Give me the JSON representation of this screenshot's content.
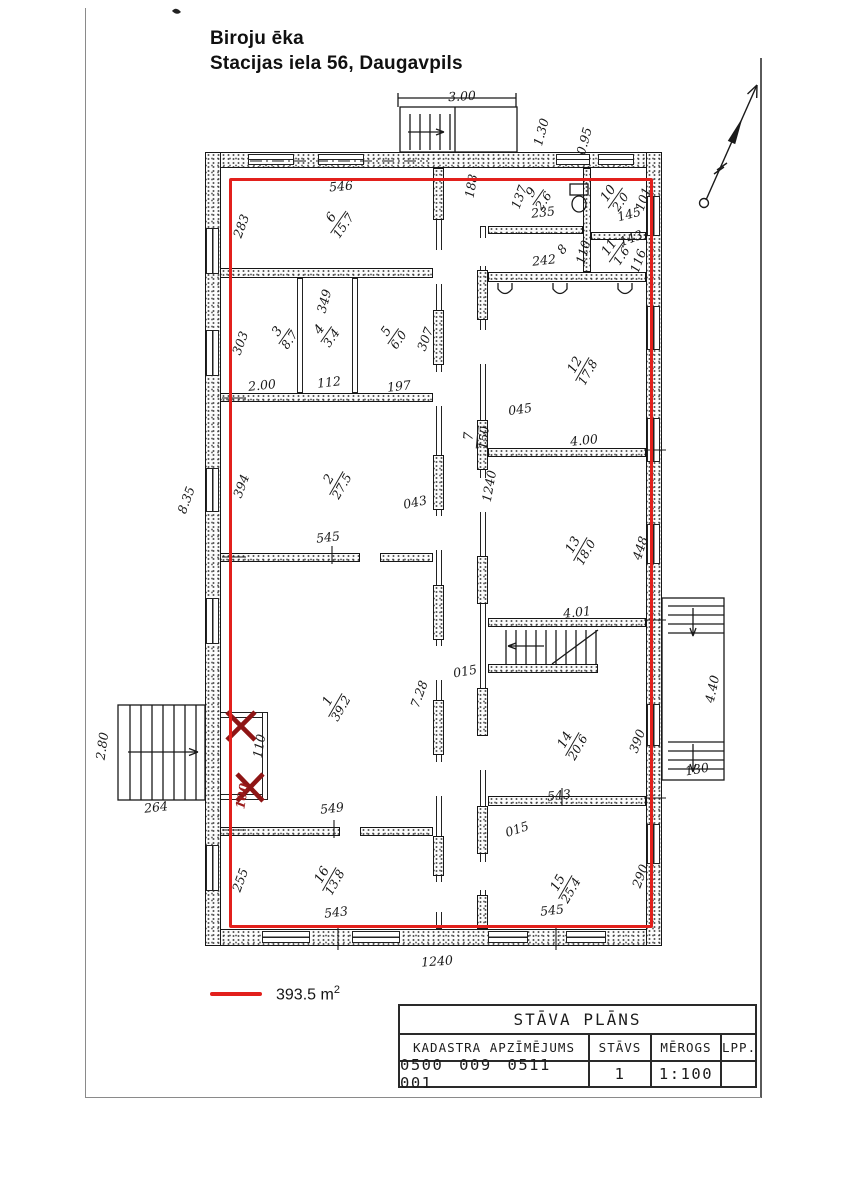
{
  "page": {
    "title_line1": "Biroju ēka",
    "title_line2": "Stacijas iela 56, Daugavpils"
  },
  "legend": {
    "area_label": "393.5 m",
    "area_sup": "2"
  },
  "title_block": {
    "title": "STĀVA PLĀNS",
    "headers": {
      "cadastre": "KADASTRA APZĪMĒJUMS",
      "floor": "STĀVS",
      "scale": "MĒROGS",
      "page": "LPP."
    },
    "values": {
      "cadastre": "0500 009 0511 001",
      "floor": "1",
      "scale": "1:100",
      "page": ""
    }
  },
  "colors": {
    "highlight_red": "#e2201c",
    "mark_red": "#8e1515",
    "ink": "#1a1a1a"
  },
  "plan": {
    "north_arrow": "north-arrow",
    "room_labels": [
      {
        "num": "6",
        "area": "15.7",
        "x": 338,
        "y": 222,
        "rot": -55
      },
      {
        "num": "9",
        "area": "2.6",
        "x": 538,
        "y": 197,
        "rot": -55
      },
      {
        "num": "10",
        "area": "2.0",
        "x": 615,
        "y": 198,
        "rot": -55
      },
      {
        "num": "11",
        "area": "1.6",
        "x": 616,
        "y": 252,
        "rot": -55
      },
      {
        "num": "3",
        "area": "8.7",
        "x": 284,
        "y": 336,
        "rot": -55
      },
      {
        "num": "4",
        "area": "3.4",
        "x": 326,
        "y": 334,
        "rot": -55
      },
      {
        "num": "5",
        "area": "6.0",
        "x": 393,
        "y": 336,
        "rot": -55
      },
      {
        "num": "2",
        "area": "27.5",
        "x": 336,
        "y": 483,
        "rot": -60
      },
      {
        "num": "7",
        "area": "150",
        "x": 477,
        "y": 437,
        "rot": -85
      },
      {
        "num": "12",
        "area": "17.8",
        "x": 582,
        "y": 369,
        "rot": -60
      },
      {
        "num": "13",
        "area": "18.0",
        "x": 580,
        "y": 549,
        "rot": -60
      },
      {
        "num": "1",
        "area": "39.2",
        "x": 335,
        "y": 705,
        "rot": -60
      },
      {
        "num": "14",
        "area": "20.6",
        "x": 572,
        "y": 744,
        "rot": -60
      },
      {
        "num": "16",
        "area": "13.8",
        "x": 329,
        "y": 879,
        "rot": -60
      },
      {
        "num": "15",
        "area": "25.4",
        "x": 565,
        "y": 887,
        "rot": -60
      }
    ],
    "dim_labels": [
      {
        "text": "3.00",
        "x": 462,
        "y": 96,
        "rot": -3
      },
      {
        "text": "1.30",
        "x": 541,
        "y": 132,
        "rot": -75
      },
      {
        "text": "0.95",
        "x": 584,
        "y": 141,
        "rot": -75
      },
      {
        "text": "546",
        "x": 341,
        "y": 186,
        "rot": -5
      },
      {
        "text": "188",
        "x": 471,
        "y": 186,
        "rot": -80
      },
      {
        "text": "283",
        "x": 241,
        "y": 226,
        "rot": -70
      },
      {
        "text": "137",
        "x": 519,
        "y": 197,
        "rot": -70
      },
      {
        "text": "235",
        "x": 543,
        "y": 212,
        "rot": -6
      },
      {
        "text": "145",
        "x": 629,
        "y": 214,
        "rot": -15
      },
      {
        "text": "101",
        "x": 643,
        "y": 199,
        "rot": -70
      },
      {
        "text": "8",
        "x": 562,
        "y": 249,
        "rot": -50
      },
      {
        "text": "242",
        "x": 544,
        "y": 260,
        "rot": -6
      },
      {
        "text": "110",
        "x": 583,
        "y": 252,
        "rot": -75
      },
      {
        "text": "143",
        "x": 631,
        "y": 238,
        "rot": -20
      },
      {
        "text": "116",
        "x": 638,
        "y": 261,
        "rot": -70
      },
      {
        "text": "303",
        "x": 240,
        "y": 343,
        "rot": -70
      },
      {
        "text": "349",
        "x": 324,
        "y": 301,
        "rot": -75
      },
      {
        "text": "307",
        "x": 425,
        "y": 339,
        "rot": -70
      },
      {
        "text": "2.00",
        "x": 262,
        "y": 385,
        "rot": -6
      },
      {
        "text": "112",
        "x": 329,
        "y": 382,
        "rot": -6
      },
      {
        "text": "197",
        "x": 399,
        "y": 386,
        "rot": -6
      },
      {
        "text": "394",
        "x": 241,
        "y": 486,
        "rot": -70
      },
      {
        "text": "8.35",
        "x": 186,
        "y": 500,
        "rot": -70
      },
      {
        "text": "545",
        "x": 328,
        "y": 537,
        "rot": -6
      },
      {
        "text": "043",
        "x": 415,
        "y": 502,
        "rot": -12
      },
      {
        "text": "045",
        "x": 520,
        "y": 409,
        "rot": -8
      },
      {
        "text": "1240",
        "x": 489,
        "y": 486,
        "rot": -80
      },
      {
        "text": "4.00",
        "x": 584,
        "y": 440,
        "rot": -6
      },
      {
        "text": "448",
        "x": 640,
        "y": 548,
        "rot": -72
      },
      {
        "text": "4.01",
        "x": 577,
        "y": 612,
        "rot": -6
      },
      {
        "text": "015",
        "x": 465,
        "y": 671,
        "rot": -10
      },
      {
        "text": "7.28",
        "x": 419,
        "y": 694,
        "rot": -70
      },
      {
        "text": "543",
        "x": 559,
        "y": 795,
        "rot": -6
      },
      {
        "text": "390",
        "x": 637,
        "y": 741,
        "rot": -70
      },
      {
        "text": "015",
        "x": 517,
        "y": 829,
        "rot": -18
      },
      {
        "text": "290",
        "x": 640,
        "y": 876,
        "rot": -70
      },
      {
        "text": "545",
        "x": 552,
        "y": 910,
        "rot": -6
      },
      {
        "text": "549",
        "x": 332,
        "y": 808,
        "rot": -6
      },
      {
        "text": "255",
        "x": 240,
        "y": 880,
        "rot": -70
      },
      {
        "text": "543",
        "x": 336,
        "y": 912,
        "rot": -6
      },
      {
        "text": "110",
        "x": 259,
        "y": 746,
        "rot": -80
      },
      {
        "text": "100",
        "x": 242,
        "y": 796,
        "rot": -80,
        "red": true
      },
      {
        "text": "2.80",
        "x": 102,
        "y": 746,
        "rot": -82
      },
      {
        "text": "264",
        "x": 156,
        "y": 807,
        "rot": -6
      },
      {
        "text": "4.40",
        "x": 712,
        "y": 689,
        "rot": -78
      },
      {
        "text": "130",
        "x": 697,
        "y": 769,
        "rot": -10
      },
      {
        "text": "1240",
        "x": 437,
        "y": 961,
        "rot": -4
      }
    ]
  }
}
